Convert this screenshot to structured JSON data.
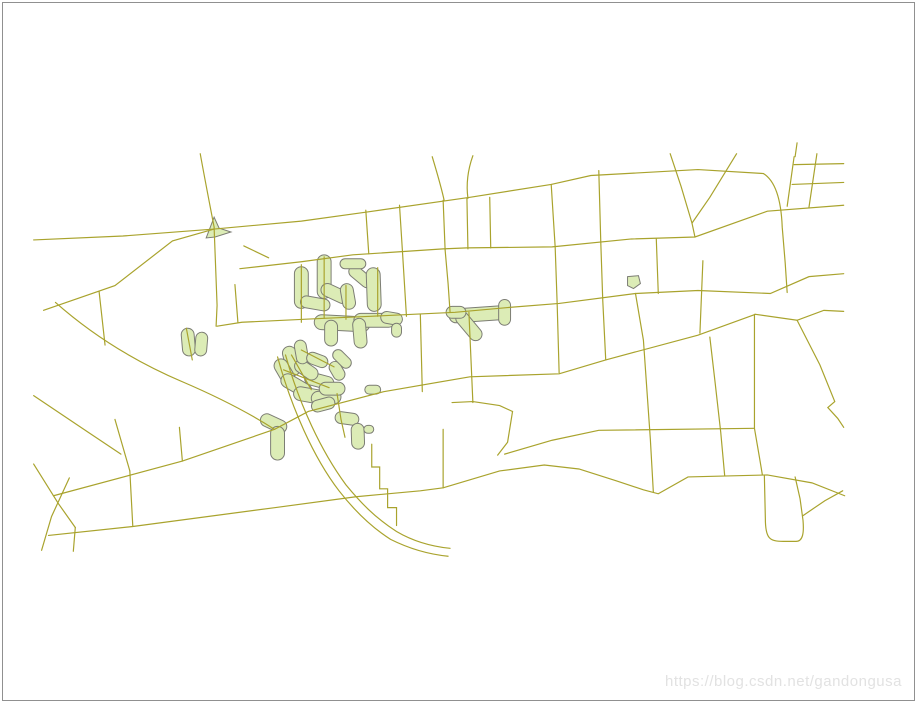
{
  "canvas": {
    "width": 917,
    "height": 703,
    "background": "#ffffff",
    "frame_border_color": "#909090"
  },
  "watermark": {
    "text": "https://blog.csdn.net/gandongusa",
    "color": "#e2e2e2"
  },
  "map": {
    "road_color": "#a9a32d",
    "road_width": 1.2,
    "buffer_fill": "#dcecb6",
    "buffer_stroke": "#7c7d74",
    "buffer_stroke_width": 1,
    "roads": [
      "M198,152 C204,185 208,205 212,226",
      "M30,239 L120,235 L212,228",
      "M212,226 L215,305 L214,326",
      "M40,310 L112,285 L170,240 L212,228",
      "M52,302 C95,340 140,365 180,382 C215,397 248,414 273,430",
      "M96,291 L102,345",
      "M184,328 L190,360",
      "M233,284 L236,322",
      "M212,228 L300,220 L365,211 L470,196 L552,183 L592,174 L700,168 L766,172",
      "M766,172 C779,180 784,200 785,226 L788,262 L790,292",
      "M238,268 L300,261 L352,254 L443,248 L467,247 L553,246 L633,238 L697,236 L770,210 L847,204",
      "M242,245 L267,257",
      "M365,209 L368,253",
      "M399,204 L402,251",
      "M443,199 L445,249",
      "M467,197 L468,248",
      "M490,196 L491,247",
      "M432,155 C437,172 441,185 444,199",
      "M473,154 C468,168 466,182 468,197",
      "M552,183 L556,246 L558,303 L560,373",
      "M600,169 L602,241 L604,300 L607,360",
      "M672,152 L683,185 L694,222 L697,236",
      "M739,152 L712,196 L694,222",
      "M658,238 L660,293",
      "M797,155 L790,205",
      "M820,152 L812,206",
      "M797,163 L847,162",
      "M795,183 L847,181",
      "M800,141 L798,155",
      "M215,326 L240,322 L323,318 L370,316 L455,312 L510,307 L560,303 L637,293 L700,290 L773,293 L812,276 L847,273",
      "M300,264 L300,322",
      "M323,256 L323,318",
      "M345,285 L345,319",
      "M377,267 L377,316",
      "M402,251 L406,316",
      "M445,249 L448,283 L450,312",
      "M705,260 L702,333",
      "M50,497 L180,462 L273,430 L307,412 L383,392 L470,377 L560,374 L607,360 L700,335 L758,314",
      "M758,314 L800,320 L827,310 L847,311",
      "M45,537 L130,528 L273,509 L355,498 L420,492 L443,489 L500,472 L545,466 L580,470 L618,482 L645,491 L660,495 L690,478 L730,477 L770,476 L815,484 L848,497",
      "M66,479 L48,518 L38,552",
      "M30,465 L55,505 L72,529",
      "M127,472 L130,528",
      "M72,529 L70,553",
      "M112,420 L127,472",
      "M30,396 L85,433 L118,455",
      "M180,462 L177,428",
      "M276,357 C290,408 312,458 338,492 C352,510 368,527 390,541 C410,551 428,556 448,558",
      "M284,355 C298,405 320,452 345,486 C359,503 374,519 396,533 C413,543 430,548 450,550",
      "M371,445 L371,468 L379,468 L379,490 L387,490 L387,509 L396,509 L396,527",
      "M443,430 L443,489",
      "M420,314 L422,392",
      "M469,312 L473,403",
      "M452,403 L473,402 L500,406 L513,412",
      "M513,412 L508,443 L498,456",
      "M505,455 L553,441 L600,431 L757,429",
      "M637,293 L645,340 L652,440 L655,493",
      "M712,337 L717,380 L723,433 L727,477",
      "M757,314 L757,429 L762,458 L765,476",
      "M800,320 L823,365 L838,402 L831,408 L841,419 L847,428",
      "M767,477 L768,520 C768,540 772,543 786,543 L799,543 C806,543 807,534 806,522 L803,500 L798,478",
      "M806,517 L828,502 L846,492",
      "M336,394 L340,420 L344,438",
      "M290,355 L310,390",
      "M282,370 L328,388",
      "M300,350 L333,367"
    ],
    "buffers": [
      {
        "cx": 300,
        "cy": 287,
        "len": 42,
        "wid": 14,
        "ang": 90
      },
      {
        "cx": 323,
        "cy": 276,
        "len": 44,
        "wid": 14,
        "ang": 90
      },
      {
        "cx": 334,
        "cy": 293,
        "len": 30,
        "wid": 13,
        "ang": 25
      },
      {
        "cx": 347,
        "cy": 296,
        "len": 26,
        "wid": 13,
        "ang": 80
      },
      {
        "cx": 360,
        "cy": 276,
        "len": 28,
        "wid": 12,
        "ang": 40
      },
      {
        "cx": 373,
        "cy": 289,
        "len": 44,
        "wid": 14,
        "ang": 88
      },
      {
        "cx": 352,
        "cy": 263,
        "len": 26,
        "wid": 10,
        "ang": 0
      },
      {
        "cx": 314,
        "cy": 303,
        "len": 30,
        "wid": 12,
        "ang": 10
      },
      {
        "cx": 341,
        "cy": 323,
        "len": 56,
        "wid": 15,
        "ang": 3
      },
      {
        "cx": 374,
        "cy": 320,
        "len": 42,
        "wid": 14,
        "ang": 0
      },
      {
        "cx": 330,
        "cy": 333,
        "len": 26,
        "wid": 13,
        "ang": 90
      },
      {
        "cx": 359,
        "cy": 333,
        "len": 30,
        "wid": 13,
        "ang": 85
      },
      {
        "cx": 391,
        "cy": 318,
        "len": 22,
        "wid": 12,
        "ang": 10
      },
      {
        "cx": 396,
        "cy": 330,
        "len": 14,
        "wid": 10,
        "ang": 90
      },
      {
        "cx": 478,
        "cy": 314,
        "len": 58,
        "wid": 14,
        "ang": -4
      },
      {
        "cx": 469,
        "cy": 326,
        "len": 34,
        "wid": 13,
        "ang": 50
      },
      {
        "cx": 505,
        "cy": 312,
        "len": 26,
        "wid": 12,
        "ang": 90
      },
      {
        "cx": 456,
        "cy": 312,
        "len": 20,
        "wid": 12,
        "ang": 0
      },
      {
        "cx": 290,
        "cy": 361,
        "len": 30,
        "wid": 14,
        "ang": 75
      },
      {
        "cx": 283,
        "cy": 372,
        "len": 28,
        "wid": 14,
        "ang": 60
      },
      {
        "cx": 295,
        "cy": 386,
        "len": 34,
        "wid": 14,
        "ang": 30
      },
      {
        "cx": 310,
        "cy": 396,
        "len": 36,
        "wid": 14,
        "ang": 10
      },
      {
        "cx": 325,
        "cy": 398,
        "len": 30,
        "wid": 14,
        "ang": -5
      },
      {
        "cx": 318,
        "cy": 381,
        "len": 30,
        "wid": 13,
        "ang": 15
      },
      {
        "cx": 305,
        "cy": 370,
        "len": 26,
        "wid": 13,
        "ang": 35
      },
      {
        "cx": 331,
        "cy": 389,
        "len": 26,
        "wid": 13,
        "ang": 0
      },
      {
        "cx": 300,
        "cy": 352,
        "len": 24,
        "wid": 12,
        "ang": 80
      },
      {
        "cx": 316,
        "cy": 360,
        "len": 22,
        "wid": 12,
        "ang": 20
      },
      {
        "cx": 322,
        "cy": 405,
        "len": 24,
        "wid": 12,
        "ang": -15
      },
      {
        "cx": 336,
        "cy": 371,
        "len": 20,
        "wid": 12,
        "ang": 60
      },
      {
        "cx": 341,
        "cy": 359,
        "len": 22,
        "wid": 11,
        "ang": 45
      },
      {
        "cx": 346,
        "cy": 419,
        "len": 24,
        "wid": 12,
        "ang": 8
      },
      {
        "cx": 357,
        "cy": 437,
        "len": 26,
        "wid": 13,
        "ang": 88
      },
      {
        "cx": 368,
        "cy": 430,
        "len": 10,
        "wid": 8,
        "ang": 0
      },
      {
        "cx": 186,
        "cy": 342,
        "len": 28,
        "wid": 13,
        "ang": 85
      },
      {
        "cx": 199,
        "cy": 344,
        "len": 24,
        "wid": 12,
        "ang": 95
      },
      {
        "cx": 272,
        "cy": 424,
        "len": 28,
        "wid": 13,
        "ang": 25
      },
      {
        "cx": 276,
        "cy": 444,
        "len": 34,
        "wid": 14,
        "ang": 90
      },
      {
        "cx": 372,
        "cy": 390,
        "len": 16,
        "wid": 9,
        "ang": 0
      }
    ],
    "polygons": [
      "M204,237 L212,216 L217,227 L229,231 L213,236 Z",
      "M629,276 L640,275 L642,283 L635,288 L629,285 Z"
    ]
  }
}
